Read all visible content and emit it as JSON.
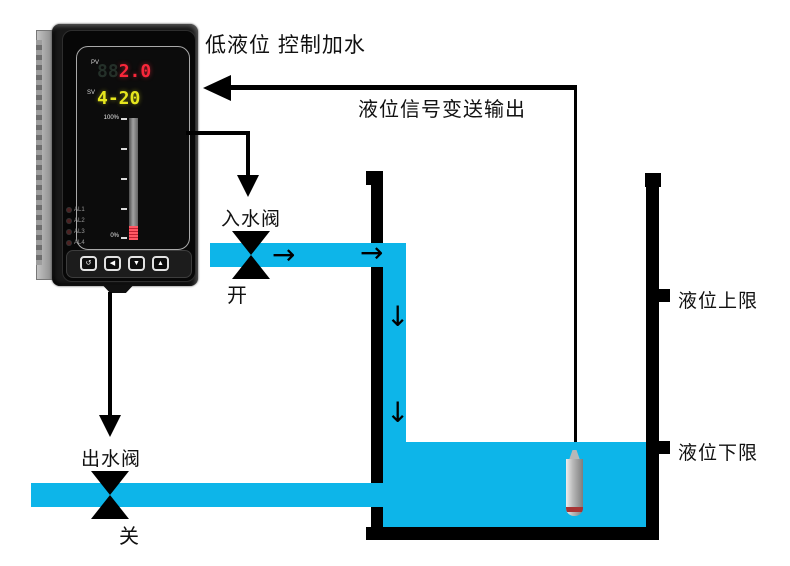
{
  "title": "低液位 控制加水",
  "signal_label": "液位信号变送输出",
  "device": {
    "pv_label": "PV",
    "pv_ghost": "88",
    "pv_value": "2.0",
    "sv_label": "SV",
    "sv_value": "4-20",
    "scale_top": "100%",
    "scale_bottom": "0%",
    "alarms": [
      "AL1",
      "AL2",
      "AL3",
      "AL4"
    ],
    "buttons": [
      {
        "name": "cycle",
        "glyph": "↺"
      },
      {
        "name": "left",
        "glyph": "◀"
      },
      {
        "name": "down",
        "glyph": "▼"
      },
      {
        "name": "up",
        "glyph": "▲"
      }
    ]
  },
  "inlet": {
    "label": "入水阀",
    "state": "开"
  },
  "outlet": {
    "label": "出水阀",
    "state": "关"
  },
  "tank": {
    "upper_limit": "液位上限",
    "lower_limit": "液位下限"
  },
  "glyphs": {
    "right_arrow": "→",
    "down_arrow": "↓"
  },
  "colors": {
    "pipe_water": "#0db5e9",
    "pv_red": "#f8273a",
    "sv_yellow": "#e6e61e",
    "bargraph_red": "#e8414e",
    "line_black": "#000000"
  }
}
